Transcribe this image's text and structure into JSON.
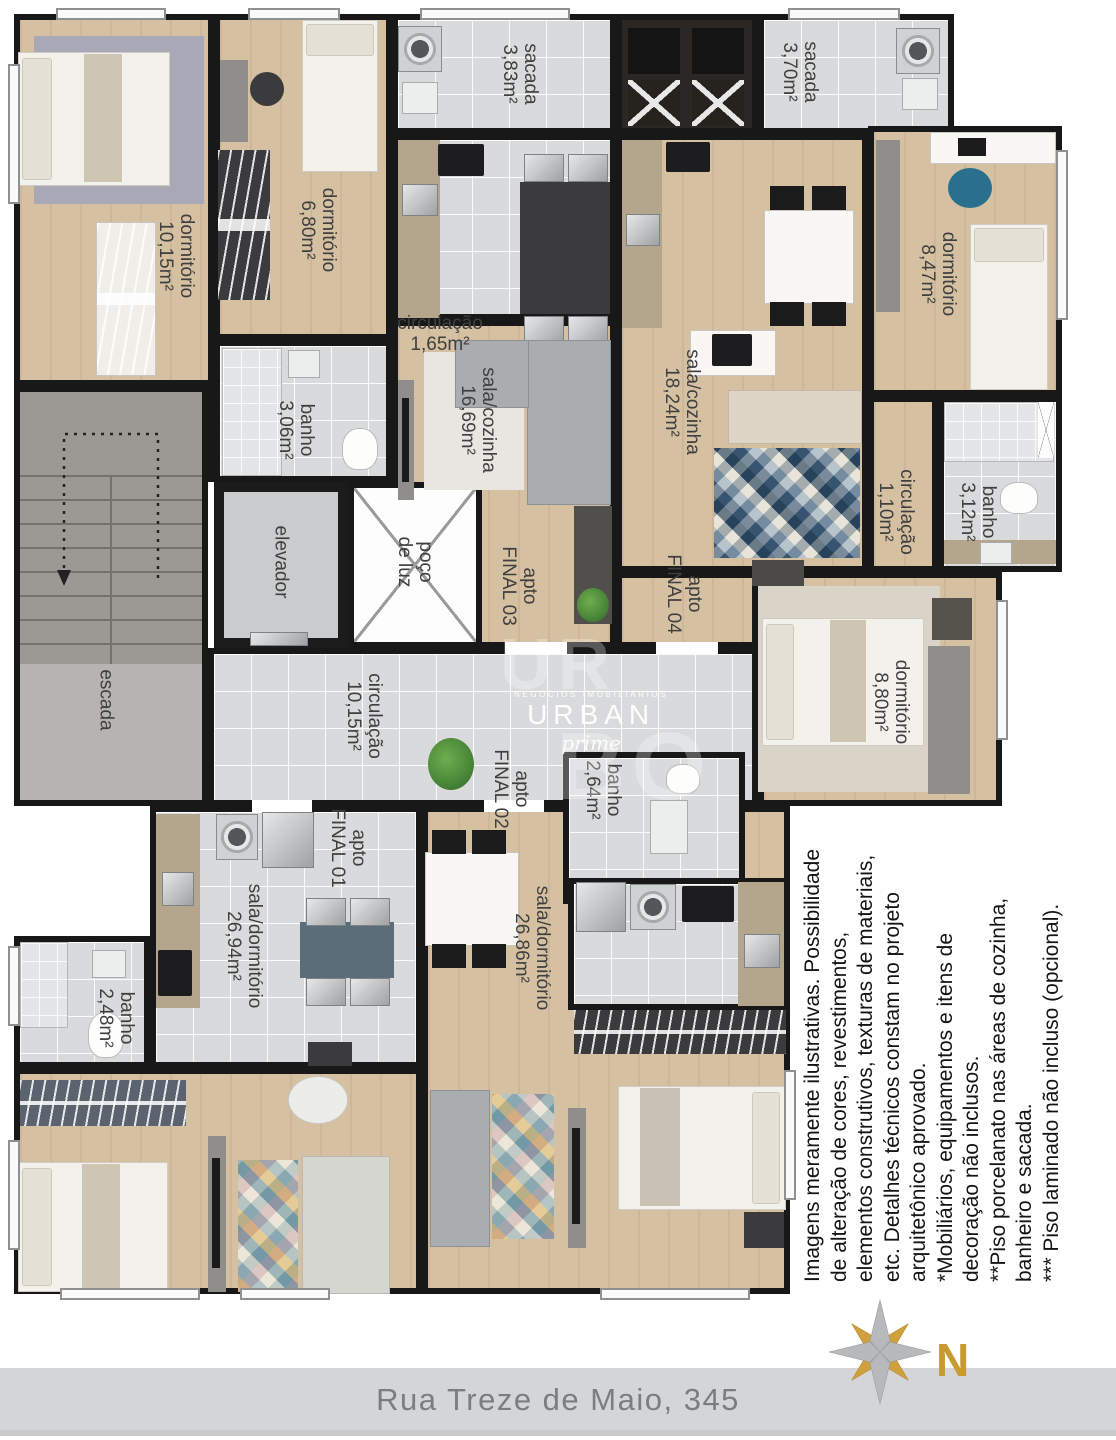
{
  "labels": {
    "dorm1015": {
      "l1": "dormitório",
      "l2": "10,15m²"
    },
    "dorm680": {
      "l1": "dormitório",
      "l2": "6,80m²"
    },
    "sacada383": {
      "l1": "sacada",
      "l2": "3,83m²"
    },
    "sacada370": {
      "l1": "sacada",
      "l2": "3,70m²"
    },
    "circ165": {
      "l1": "circulação",
      "l2": "1,65m²"
    },
    "sala1669": {
      "l1": "sala/cozinha",
      "l2": "16,69m²"
    },
    "sala1824": {
      "l1": "sala/cozinha",
      "l2": "18,24m²"
    },
    "dorm847": {
      "l1": "dormitório",
      "l2": "8,47m²"
    },
    "banho306": {
      "l1": "banho",
      "l2": "3,06m²"
    },
    "banho312": {
      "l1": "banho",
      "l2": "3,12m²"
    },
    "circ110": {
      "l1": "circulação",
      "l2": "1,10m²"
    },
    "elevador": {
      "l1": "elevador"
    },
    "poco": {
      "l1": "poço",
      "l2": "de luz"
    },
    "escada": {
      "l1": "escada"
    },
    "apto3": {
      "l1": "apto",
      "l2": "FINAL 03"
    },
    "apto4": {
      "l1": "apto",
      "l2": "FINAL 04"
    },
    "circ1015": {
      "l1": "circulação",
      "l2": "10,15m²"
    },
    "dorm880": {
      "l1": "dormitório",
      "l2": "8,80m²"
    },
    "banho264": {
      "l1": "banho",
      "l2": "2,64m²"
    },
    "apto2": {
      "l1": "apto",
      "l2": "FINAL 02"
    },
    "apto1": {
      "l1": "apto",
      "l2": "FINAL 01"
    },
    "sala2694": {
      "l1": "sala/dormitório",
      "l2": "26,94m²"
    },
    "sala2686": {
      "l1": "sala/dormitório",
      "l2": "26,86m²"
    },
    "banho248": {
      "l1": "banho",
      "l2": "2,48m²"
    }
  },
  "watermark": {
    "tagline": "NEGÓCIOS IMOBILIÁRIOS",
    "brand": "URBAN",
    "script": "prime",
    "big_top": "UR",
    "big_bottom": "BO"
  },
  "disclaimer": {
    "lines": [
      "Imagens meramente ilustrativas. Possibilidade",
      "de alteração de cores, revestimentos,",
      "elementos construtivos, texturas de materiais,",
      "etc. Detalhes técnicos constam no projeto",
      "arquitetônico aprovado.",
      "*Mobiliários, equipamentos e itens de",
      "decoração não inclusos.",
      "**Piso porcelanato nas áreas de cozinha,",
      "banheiro e sacada.",
      "*** Piso laminado não incluso (opcional)."
    ]
  },
  "footer": {
    "address": "Rua Treze de Maio, 345"
  },
  "compass": {
    "north": "N"
  },
  "colors": {
    "wall": "#181818",
    "wood_floor": "#d5c0a1",
    "tile_floor": "#d9dadb",
    "compass_gold": "#cfa13c",
    "compass_silver": "#b7b9ba",
    "footer_bg": "#d4d5d7"
  }
}
